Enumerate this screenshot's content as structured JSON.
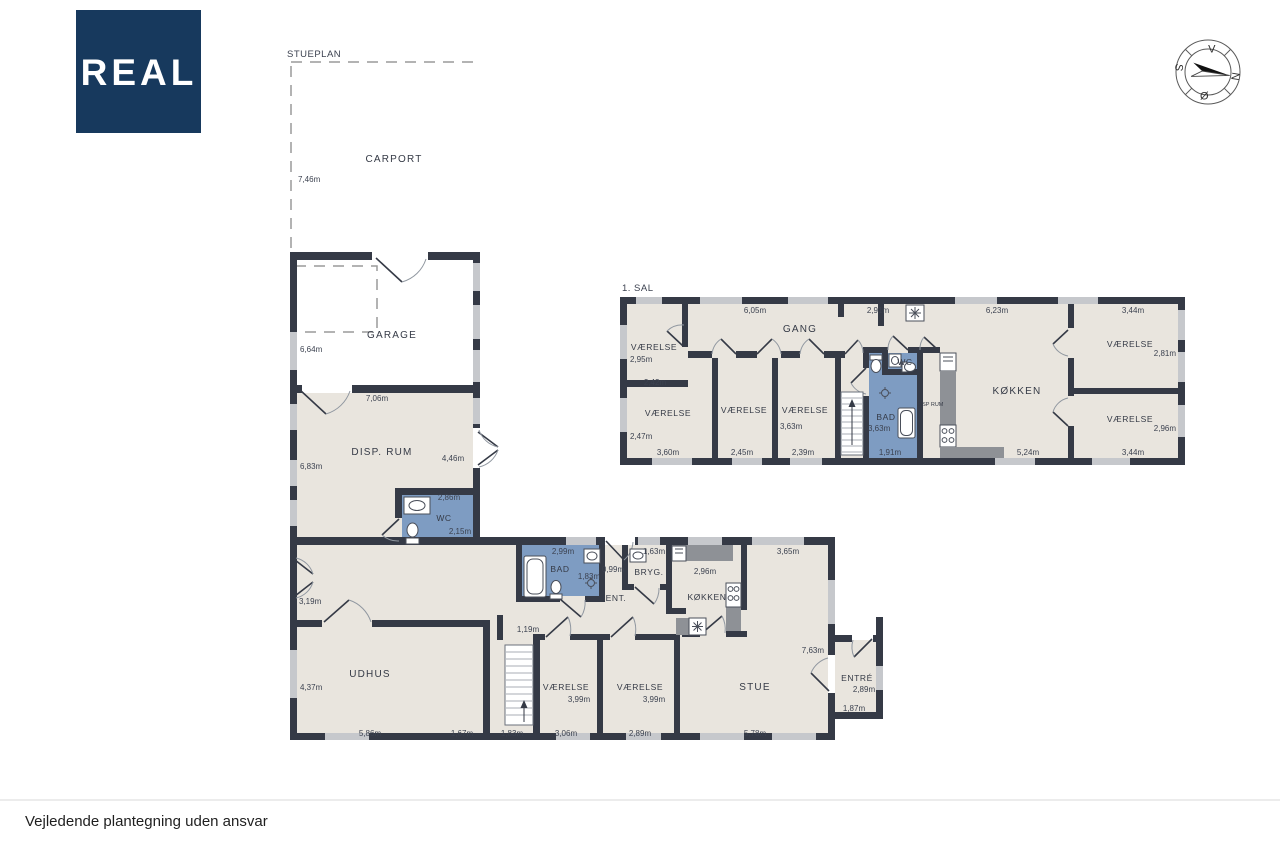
{
  "branding": {
    "logo_text": "REAL",
    "logo_bg": "#17395d"
  },
  "compass": {
    "top": "V",
    "right": "N",
    "bottom": "Ø",
    "left": "S"
  },
  "footer": {
    "disclaimer": "Vejledende plantegning uden ansvar"
  },
  "colors": {
    "wall": "#353a46",
    "floor": "#e9e5de",
    "wet_room": "#7e9cc2",
    "counter": "#8e9196",
    "window": "#c6c8cc"
  },
  "ground_floor": {
    "title": "STUEPLAN",
    "carport": {
      "label": "CARPORT",
      "left": "7,46m"
    },
    "garage": {
      "label": "GARAGE",
      "left": "6,64m",
      "bottom": "7,06m"
    },
    "disp_rum": {
      "label": "DISP. RUM",
      "left": "6,83m",
      "right": "4,46m"
    },
    "wc": {
      "label": "WC",
      "top": "2,86m",
      "right": "2,15m"
    },
    "hall": {
      "left": "3,19m"
    },
    "udhus": {
      "label": "UDHUS",
      "left": "4,37m",
      "bottom": "5,86m"
    },
    "gap_1": "1,67m",
    "gap_2": "1,83m",
    "stair_gap": "1,19m",
    "vaerelse_1": {
      "label": "VÆRELSE",
      "size": "3,99m",
      "bottom": "3,06m"
    },
    "vaerelse_2": {
      "label": "VÆRELSE",
      "size": "3,99m",
      "bottom": "2,89m"
    },
    "bad": {
      "label": "BAD",
      "top": "2,99m",
      "right": "1,83m"
    },
    "ent": {
      "label": "ENT.",
      "top": "0,99m"
    },
    "bryg": {
      "label": "BRYG.",
      "top": "1,63m"
    },
    "kokken": {
      "label": "KØKKEN",
      "top": "2,96m"
    },
    "stue": {
      "label": "STUE",
      "top": "3,65m",
      "right": "7,63m",
      "bottom": "5,78m"
    },
    "entre": {
      "label": "ENTRÉ",
      "right": "2,89m",
      "bottom": "1,87m"
    }
  },
  "first_floor": {
    "title": "1. SAL",
    "gang": {
      "label": "GANG",
      "dim_left": "6,05m",
      "dim_right": "2,91m"
    },
    "vaerelse_nw": {
      "label": "VÆRELSE",
      "left": "2,95m",
      "bottom": "2,42m"
    },
    "vaerelse_w": {
      "label": "VÆRELSE",
      "left": "2,47m",
      "bottom": "3,60m"
    },
    "vaerelse_c": {
      "label": "VÆRELSE",
      "bottom": "2,45m"
    },
    "vaerelse_c2": {
      "label": "VÆRELSE",
      "right": "3,63m",
      "bottom": "2,39m"
    },
    "bad": {
      "label": "BAD",
      "left": "3,63m",
      "bottom": "1,91m"
    },
    "wc": {
      "label": "WC"
    },
    "disp_rum": {
      "label": "DISP RUM"
    },
    "kokken": {
      "label": "KØKKEN",
      "top": "6,23m",
      "bottom": "5,24m"
    },
    "vaerelse_ne": {
      "label": "VÆRELSE",
      "top": "3,44m",
      "right": "2,81m"
    },
    "vaerelse_se": {
      "label": "VÆRELSE",
      "right": "2,96m",
      "bottom": "3,44m"
    }
  }
}
